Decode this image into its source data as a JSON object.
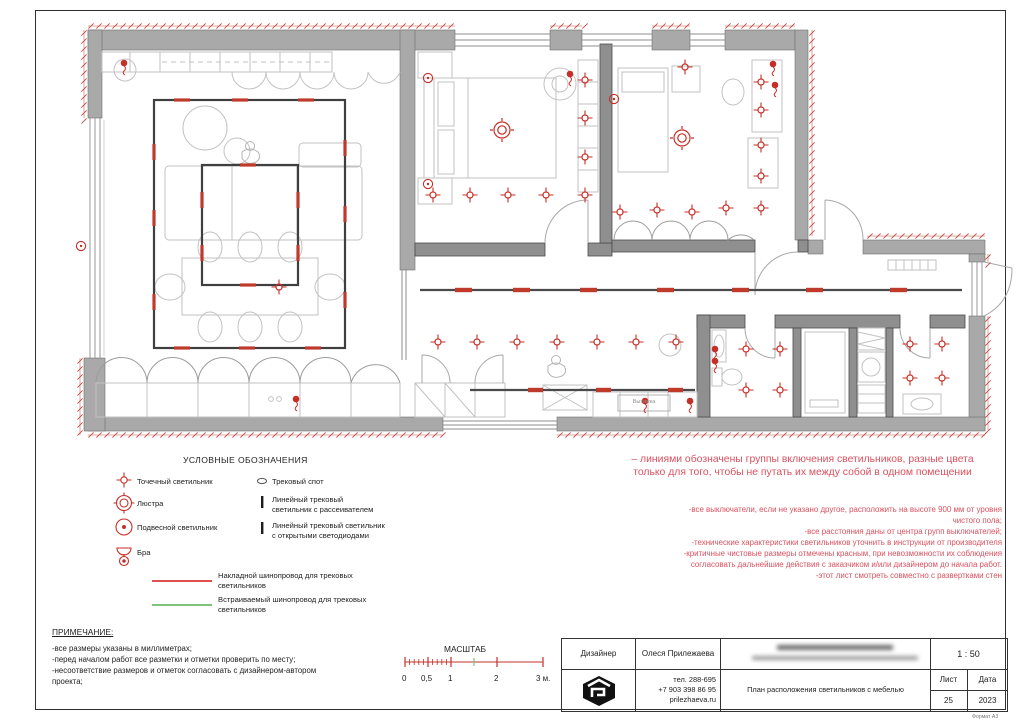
{
  "sheet": {
    "format_label": "Формат А3"
  },
  "plan": {
    "exhaust_label": "Вытяжка",
    "colors": {
      "symbol_red": "#c62f27",
      "track_red": "#bf3a2b",
      "hatch_red": "#c04a42",
      "wall_gray": "#a9a9a9",
      "inner_wall_gray": "#8f8f8f",
      "track_dark": "#3f3f3f",
      "furniture_gray": "#c2c2c2",
      "note_pink": "#d9515f",
      "green": "#7cc47c"
    },
    "point_lights": [
      [
        433,
        195
      ],
      [
        470,
        195
      ],
      [
        508,
        195
      ],
      [
        546,
        195
      ],
      [
        585,
        195
      ],
      [
        585,
        157
      ],
      [
        585,
        118
      ],
      [
        585,
        80
      ],
      [
        620,
        212
      ],
      [
        657,
        210
      ],
      [
        692,
        212
      ],
      [
        685,
        67
      ],
      [
        761,
        82
      ],
      [
        761,
        110
      ],
      [
        761,
        145
      ],
      [
        761,
        176
      ],
      [
        761,
        208
      ],
      [
        726,
        208
      ],
      [
        438,
        342
      ],
      [
        477,
        342
      ],
      [
        517,
        342
      ],
      [
        557,
        342
      ],
      [
        597,
        342
      ],
      [
        636,
        342
      ],
      [
        676,
        342
      ],
      [
        746,
        349
      ],
      [
        780,
        349
      ],
      [
        746,
        390
      ],
      [
        780,
        390
      ],
      [
        910,
        344
      ],
      [
        942,
        344
      ],
      [
        910,
        378
      ],
      [
        942,
        378
      ],
      [
        279,
        287
      ]
    ],
    "chandeliers": [
      [
        502,
        130
      ],
      [
        682,
        138
      ]
    ],
    "dot_lights": [
      [
        124,
        63
      ],
      [
        645,
        401
      ],
      [
        690,
        401
      ],
      [
        296,
        399
      ],
      [
        570,
        74
      ],
      [
        773,
        64
      ],
      [
        775,
        85
      ],
      [
        715,
        349
      ],
      [
        715,
        361
      ]
    ],
    "sconces": [
      [
        428,
        78
      ],
      [
        428,
        184
      ],
      [
        614,
        99
      ],
      [
        81,
        246
      ]
    ],
    "track_ticks": [
      {
        "x": 182,
        "y": 100,
        "o": "h"
      },
      {
        "x": 240,
        "y": 100,
        "o": "h"
      },
      {
        "x": 306,
        "y": 100,
        "o": "h"
      },
      {
        "x": 182,
        "y": 348,
        "o": "h"
      },
      {
        "x": 247,
        "y": 348,
        "o": "h"
      },
      {
        "x": 313,
        "y": 348,
        "o": "h"
      },
      {
        "x": 154,
        "y": 152,
        "o": "v"
      },
      {
        "x": 154,
        "y": 218,
        "o": "v"
      },
      {
        "x": 154,
        "y": 302,
        "o": "v"
      },
      {
        "x": 345,
        "y": 148,
        "o": "v"
      },
      {
        "x": 345,
        "y": 214,
        "o": "v"
      },
      {
        "x": 345,
        "y": 300,
        "o": "v"
      },
      {
        "x": 248,
        "y": 165,
        "o": "h"
      },
      {
        "x": 248,
        "y": 285,
        "o": "h"
      },
      {
        "x": 202,
        "y": 200,
        "o": "v"
      },
      {
        "x": 202,
        "y": 253,
        "o": "v"
      },
      {
        "x": 298,
        "y": 200,
        "o": "v"
      },
      {
        "x": 298,
        "y": 253,
        "o": "v"
      }
    ],
    "tracks": [
      {
        "x1": 420,
        "y1": 290,
        "x2": 962,
        "y2": 290,
        "segs": [
          455,
          513,
          580,
          657,
          732,
          806,
          890
        ],
        "seg_len": 17
      },
      {
        "x1": 470,
        "y1": 390,
        "x2": 695,
        "y2": 390,
        "segs": [
          528,
          596,
          668
        ],
        "seg_len": 15
      }
    ],
    "hatch_segments": [
      [
        88,
        26,
        455,
        26
      ],
      [
        550,
        26,
        582,
        26
      ],
      [
        652,
        26,
        690,
        26
      ],
      [
        725,
        26,
        795,
        26
      ],
      [
        812,
        30,
        812,
        236
      ],
      [
        867,
        236,
        985,
        236
      ],
      [
        988,
        254,
        988,
        262
      ],
      [
        988,
        316,
        988,
        430
      ],
      [
        88,
        435,
        443,
        435
      ],
      [
        557,
        435,
        985,
        435
      ],
      [
        84,
        30,
        84,
        118
      ],
      [
        80,
        358,
        80,
        435
      ]
    ]
  },
  "legend": {
    "title": "УСЛОВНЫЕ ОБОЗНАЧЕНИЯ",
    "items": {
      "point": "Точечный светильник",
      "chandelier": "Люстра",
      "pendant": "Подвесной светильник",
      "sconce": "Бра",
      "track_spot": "Трековый спот",
      "linear_diffuser": "Линейный трековый\nсветильник с рассеивателем",
      "linear_led": "Линейный трековый светильник\nс открытыми светодиодами",
      "surface_track": "Накладной шинопровод для трековых\nсветильников",
      "recessed_track": "Встраиваемый шинопровод для трековых\nсветильников"
    }
  },
  "notes_left": {
    "title": "ПРИМЕЧАНИЕ:",
    "lines": [
      "-все размеры указаны в миллиметрах;",
      "-перед началом работ все разметки и отметки проверить по месту;",
      "-несоответствие размеров и отметок согласовать с дизайнером-автором",
      "проекта;"
    ]
  },
  "notes_right": {
    "headline": "– линиями обозначены группы включения светильников, разные цвета\nтолько для того, чтобы не путать их между собой в одном помещении",
    "lines": [
      "-все выключатели, если не указано другое, расположить на высоте 900 мм от уровня",
      "чистого пола;",
      "-все расстояния даны от центра групп выключателей;",
      "-технические характеристики светильников уточнить в инструкции от производителя",
      "-критичные чистовые размеры отмечены красным, при невозможности их соблюдения",
      "согласовать дальнейшие действия с заказчиком и/или дизайнером до начала работ.",
      "-этот лист смотреть совместно с развертками стен"
    ]
  },
  "scale_bar": {
    "title": "МАСШТАБ",
    "labels": [
      "0",
      "0,5",
      "1",
      "2",
      "3 м."
    ]
  },
  "title_block": {
    "designer_label": "Дизайнер",
    "designer_name": "Олеся Прилежаева",
    "scale_value": "1 : 50",
    "phone1": "тел. 288-695",
    "phone2": "+7 903 398 86 95",
    "website": "prilezhaeva.ru",
    "drawing_title": "План расположения светильников с мебелью",
    "sheet_label": "Лист",
    "date_label": "Дата",
    "sheet_number": "25",
    "date_value": "2023"
  }
}
